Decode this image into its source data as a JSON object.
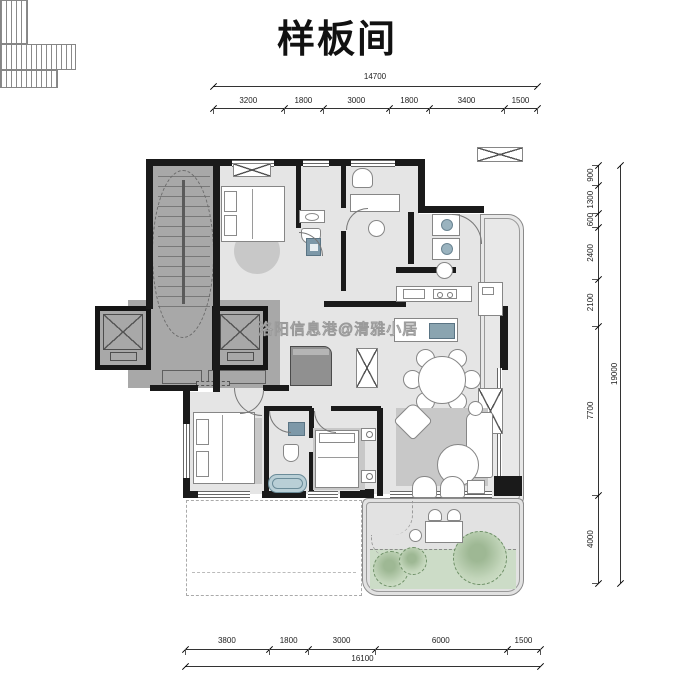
{
  "title": "样板间",
  "watermark": "洛阳信息港@清雅小居",
  "dimensions": {
    "top": {
      "total": "14700",
      "segments": [
        "3200",
        "1800",
        "3000",
        "1800",
        "3400",
        "1500"
      ]
    },
    "right": {
      "total": "19000",
      "segments": [
        "900",
        "1300",
        "600",
        "2400",
        "2100",
        "7700",
        "4000"
      ]
    },
    "bottom": {
      "total": "16100",
      "segments": [
        "3800",
        "1800",
        "3000",
        "6000",
        "1500"
      ]
    }
  },
  "colors": {
    "wall": "#1a1a1a",
    "core_fill": "#a8a8a8",
    "floor_fill": "#e5e5e5",
    "rug": "#c8c8c8",
    "plant_green": "#ccdcc7",
    "bathtub_blue": "#b9cfd6",
    "appliance_blue": "#7d98a8",
    "dimension_text": "#222222"
  }
}
